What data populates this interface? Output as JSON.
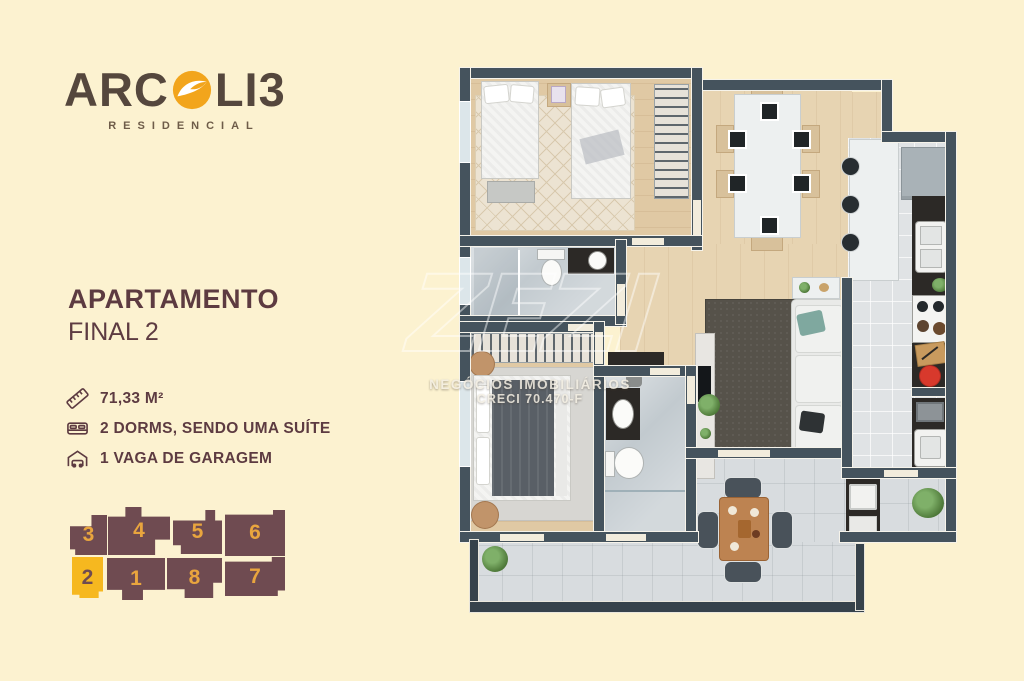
{
  "page": {
    "background_color": "#fcf2d0"
  },
  "logo": {
    "text_start": "ARC",
    "text_end": "LI3",
    "subtitle": "RESIDENCIAL",
    "gold": "#f2a51c",
    "brown": "#55473d"
  },
  "listing": {
    "title": "APARTAMENTO",
    "subtitle": "FINAL 2",
    "specs": [
      {
        "icon": "ruler-icon",
        "label": "71,33 M²"
      },
      {
        "icon": "bed-icon",
        "label": "2 DORMS, SENDO UMA SUÍTE"
      },
      {
        "icon": "car-icon",
        "label": "1 VAGA DE GARAGEM"
      }
    ]
  },
  "unit_map": {
    "highlighted_unit": "2",
    "unit_color": "#6f4b51",
    "highlight_color": "#f6b81f",
    "number_color": "#e9a53e",
    "units": [
      {
        "number": "3"
      },
      {
        "number": "4"
      },
      {
        "number": "5"
      },
      {
        "number": "6"
      },
      {
        "number": "2"
      },
      {
        "number": "1"
      },
      {
        "number": "8"
      },
      {
        "number": "7"
      }
    ]
  },
  "watermark": {
    "brand": "ZEZI",
    "line1": "NEGÓCIOS IMOBILIÁRIOS",
    "line2": "CRECI 70.470-F"
  },
  "colors": {
    "wall": "#45535d",
    "title_maroon": "#5d3b41"
  }
}
